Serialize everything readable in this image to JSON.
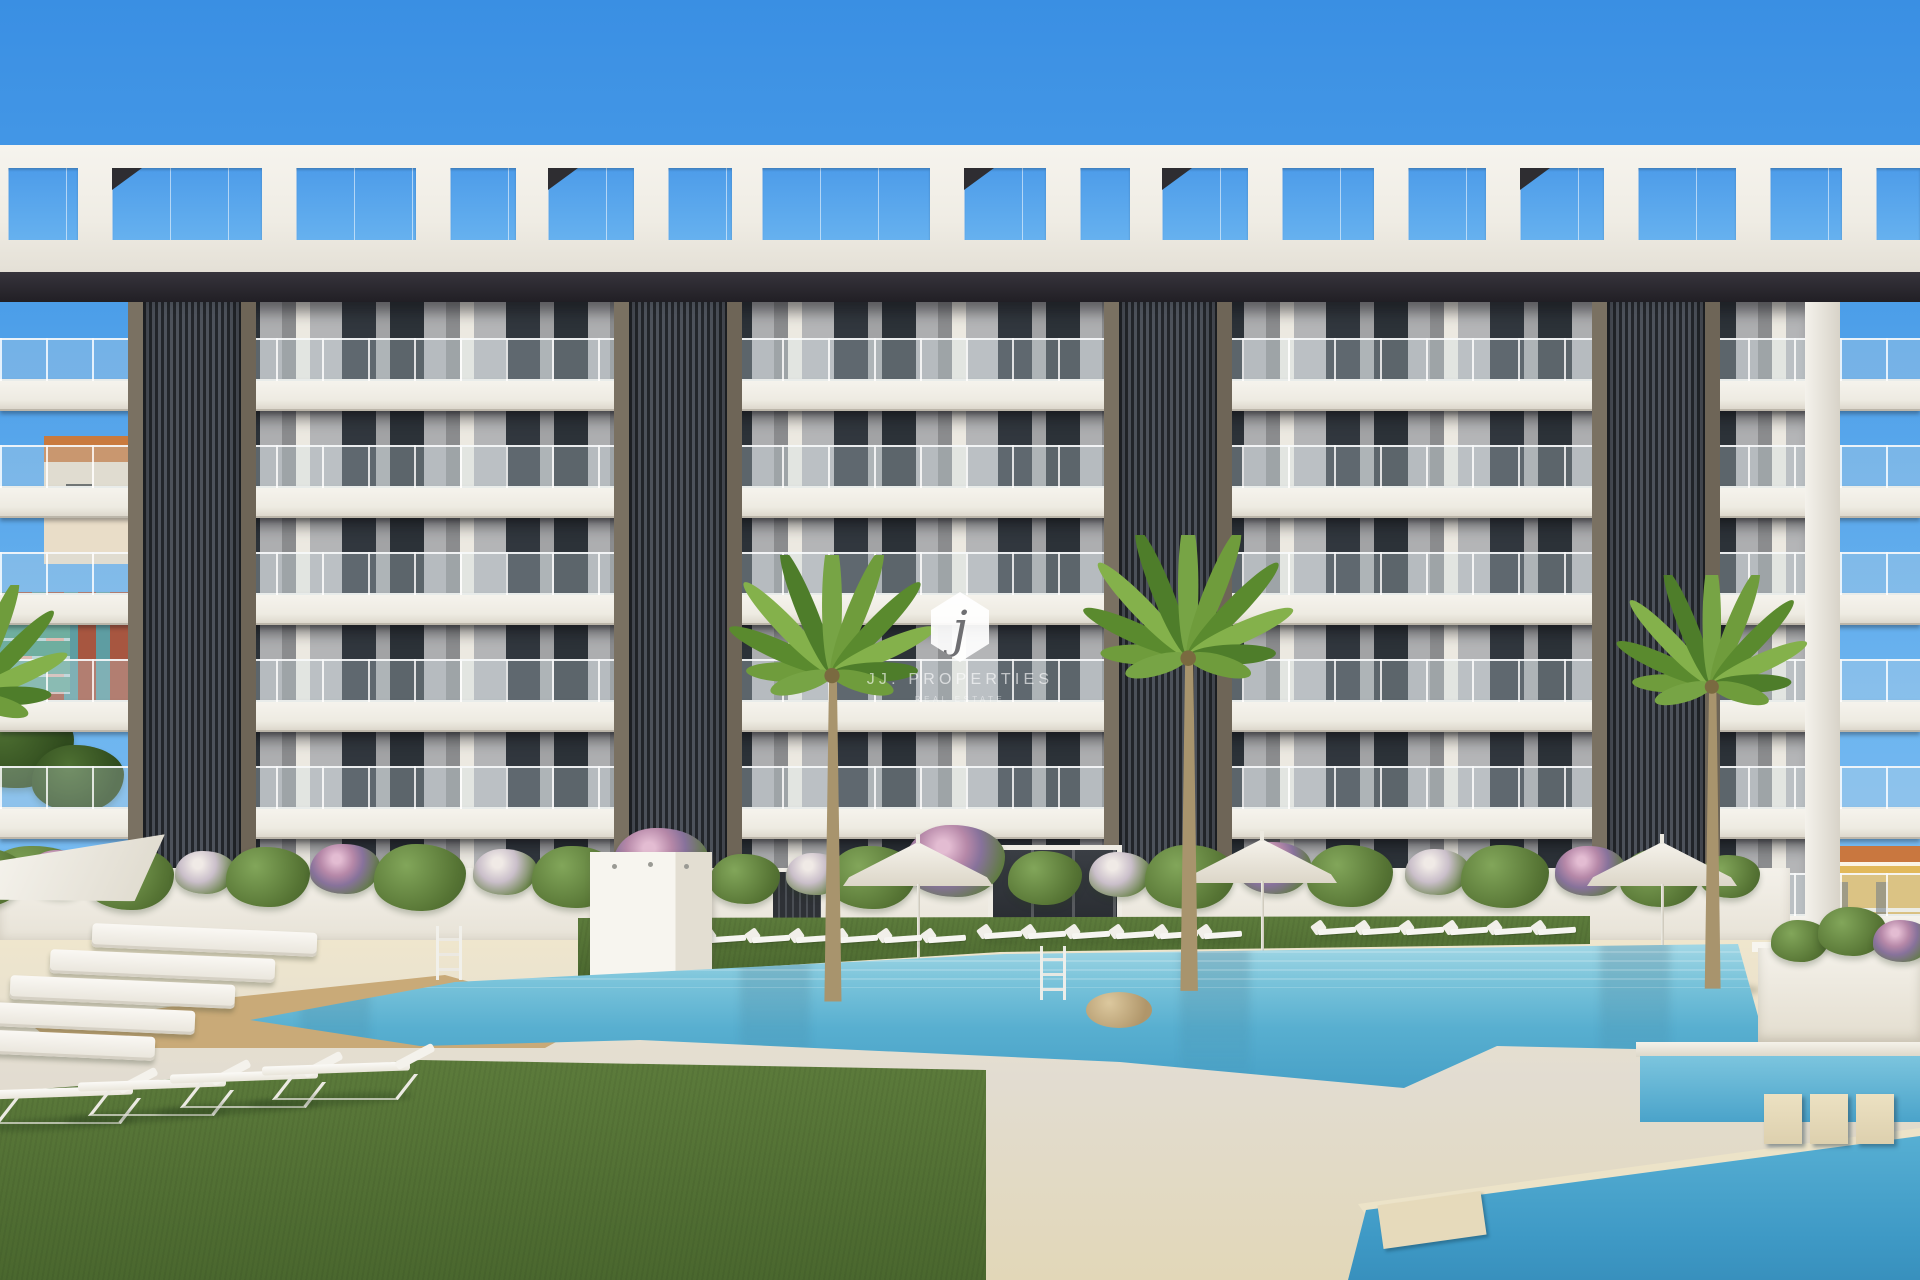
{
  "watermark": {
    "logo_letter": "j",
    "brand": "JJ. PROPERTIES",
    "tagline": "REAL ESTATE"
  },
  "palette": {
    "sky": "#4d9fe9",
    "pool_water": "#58afd0",
    "sand": "#e7ddc1",
    "grass": "#55733a",
    "facade_white": "#f0ede6",
    "facade_gray": "#adaeb0",
    "slat_dark": "#3d4147",
    "wood_deck": "#c3a374",
    "flower_pink": "#c496b8",
    "bg_house_yellow": "#e2b95b",
    "bg_house_red": "#a75640"
  },
  "scene": {
    "roof_openings": [
      [
        8,
        70,
        0
      ],
      [
        112,
        150,
        1
      ],
      [
        296,
        120,
        0
      ],
      [
        450,
        66,
        0
      ],
      [
        548,
        86,
        1
      ],
      [
        668,
        64,
        0
      ],
      [
        762,
        168,
        0
      ],
      [
        964,
        82,
        1
      ],
      [
        1080,
        50,
        0
      ],
      [
        1162,
        86,
        1
      ],
      [
        1282,
        92,
        0
      ],
      [
        1408,
        78,
        0
      ],
      [
        1520,
        84,
        1
      ],
      [
        1638,
        98,
        0
      ],
      [
        1770,
        72,
        0
      ],
      [
        1876,
        44,
        0
      ]
    ],
    "towers": [
      128,
      614,
      1104,
      1592
    ],
    "floors": 6,
    "umbrellas": [
      [
        918,
        834
      ],
      [
        1262,
        831
      ],
      [
        1662,
        834
      ]
    ],
    "palms": [
      [
        832,
        555,
        0.95
      ],
      [
        1188,
        535,
        0.97
      ],
      [
        1712,
        575,
        0.88
      ],
      [
        -30,
        585,
        0.9
      ]
    ],
    "ladders": [
      [
        436,
        926
      ],
      [
        1040,
        946
      ]
    ],
    "lounger_rows": [
      [
        702,
        928,
        6
      ],
      [
        978,
        924,
        6
      ],
      [
        1312,
        920,
        6
      ]
    ],
    "deck_cushions": [
      [
        92,
        928
      ],
      [
        50,
        954
      ],
      [
        10,
        980
      ],
      [
        -30,
        1006
      ],
      [
        -70,
        1032
      ]
    ],
    "flat_loungers": [
      [
        -15,
        1076
      ],
      [
        78,
        1068
      ],
      [
        170,
        1060
      ],
      [
        262,
        1052
      ]
    ],
    "bushes": [
      [
        -15,
        892,
        80,
        "g"
      ],
      [
        60,
        886,
        66,
        "p"
      ],
      [
        130,
        895,
        88,
        "g"
      ],
      [
        205,
        884,
        60,
        "w"
      ],
      [
        268,
        893,
        84,
        "g"
      ],
      [
        345,
        882,
        70,
        "p"
      ],
      [
        420,
        895,
        92,
        "g"
      ],
      [
        505,
        884,
        64,
        "w"
      ],
      [
        575,
        893,
        86,
        "g"
      ],
      [
        660,
        880,
        95,
        "p"
      ],
      [
        745,
        892,
        70,
        "g"
      ],
      [
        815,
        885,
        58,
        "w"
      ],
      [
        872,
        894,
        88,
        "g"
      ],
      [
        955,
        880,
        100,
        "p"
      ],
      [
        1045,
        892,
        74,
        "g"
      ],
      [
        1120,
        886,
        62,
        "w"
      ],
      [
        1190,
        894,
        90,
        "g"
      ],
      [
        1275,
        882,
        72,
        "p"
      ],
      [
        1350,
        892,
        86,
        "g"
      ],
      [
        1437,
        884,
        64,
        "w"
      ],
      [
        1505,
        893,
        88,
        "g"
      ],
      [
        1590,
        884,
        70,
        "p"
      ],
      [
        1660,
        893,
        80,
        "g"
      ],
      [
        1730,
        888,
        60,
        "g"
      ]
    ],
    "planter_shrubs": [
      [
        1800,
        952,
        58,
        "g"
      ],
      [
        1852,
        944,
        68,
        "g"
      ],
      [
        1902,
        952,
        58,
        "p"
      ]
    ],
    "bg_trees": [
      [
        14,
        768,
        120,
        "t"
      ],
      [
        78,
        796,
        92,
        "t"
      ],
      [
        36,
        912,
        120,
        "g"
      ]
    ]
  }
}
